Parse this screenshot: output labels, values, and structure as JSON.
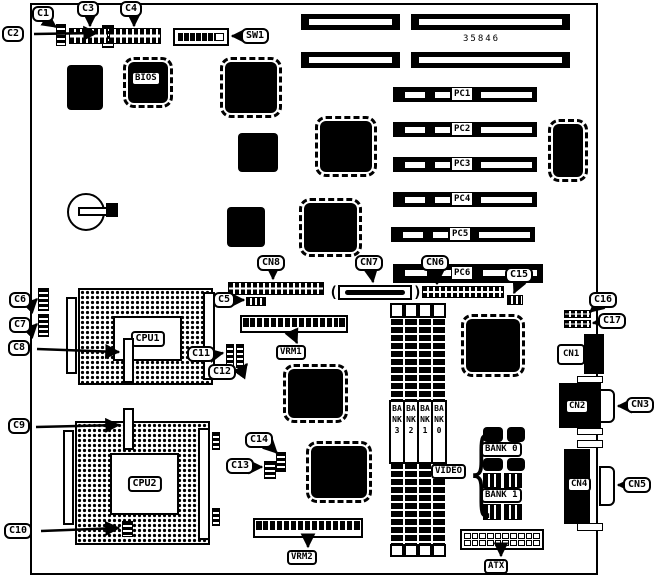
{
  "figure": {
    "part_number": "35846"
  },
  "callouts": {
    "c1": "C1",
    "c2": "C2",
    "c3": "C3",
    "c4": "C4",
    "c5": "C5",
    "c6": "C6",
    "c7": "C7",
    "c8": "C8",
    "c9": "C9",
    "c10": "C10",
    "c11": "C11",
    "c12": "C12",
    "c13": "C13",
    "c14": "C14",
    "c15": "C15",
    "c16": "C16",
    "c17": "C17",
    "cn3": "CN3",
    "cn5": "CN5",
    "cn6": "CN6",
    "cn7": "CN7",
    "cn8": "CN8",
    "sw1": "SW1"
  },
  "component_labels": {
    "bios": "BIOS",
    "cpu1": "CPU1",
    "cpu2": "CPU2",
    "vrm1": "VRM1",
    "vrm2": "VRM2",
    "video": "VIDEO",
    "atx": "ATX",
    "cn1": "CN1",
    "cn2": "CN2",
    "cn4": "CN4",
    "bank0": "BANK 0",
    "bank1": "BANK 1"
  },
  "pci_slots": [
    "PC1",
    "PC2",
    "PC3",
    "PC4",
    "PC5",
    "PC6"
  ],
  "memory_banks": [
    "BANK 3",
    "BANK 2",
    "BANK 1",
    "BANK 0"
  ]
}
